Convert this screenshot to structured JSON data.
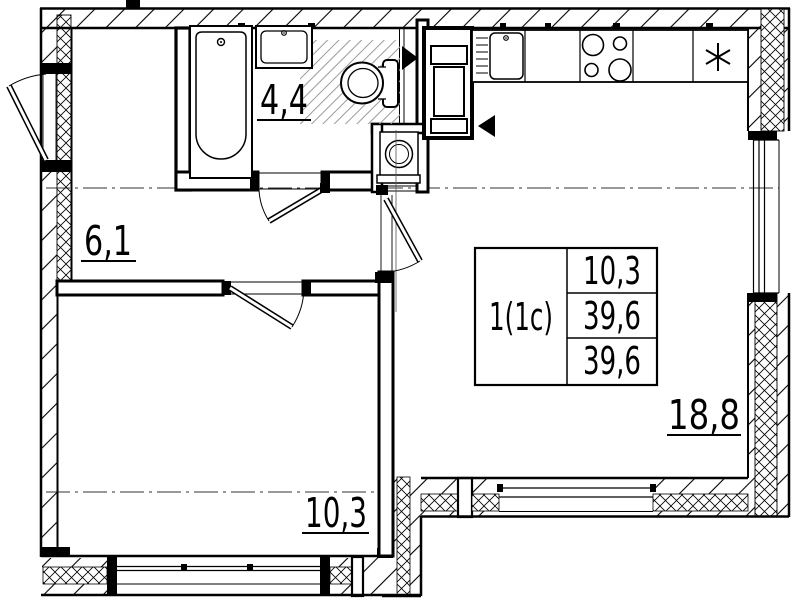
{
  "title": "apartment-floor-plan",
  "rooms": {
    "bathroom": {
      "area": "4,4"
    },
    "hallway": {
      "area": "6,1"
    },
    "bedroom": {
      "area": "10,3"
    },
    "living_room": {
      "area": "18,8"
    }
  },
  "info_table": {
    "unit_type": "1(1c)",
    "row_living_area": "10,3",
    "row_area": "39,6",
    "row_total_area": "39,6"
  },
  "icons": {
    "fridge_symbol": "*",
    "vent_arrow_right": "black right triangle",
    "vent_arrow_left": "black left triangle"
  },
  "colors": {
    "line": "#000000",
    "shower_hatch": "#9b9b9b",
    "background": "#ffffff"
  }
}
